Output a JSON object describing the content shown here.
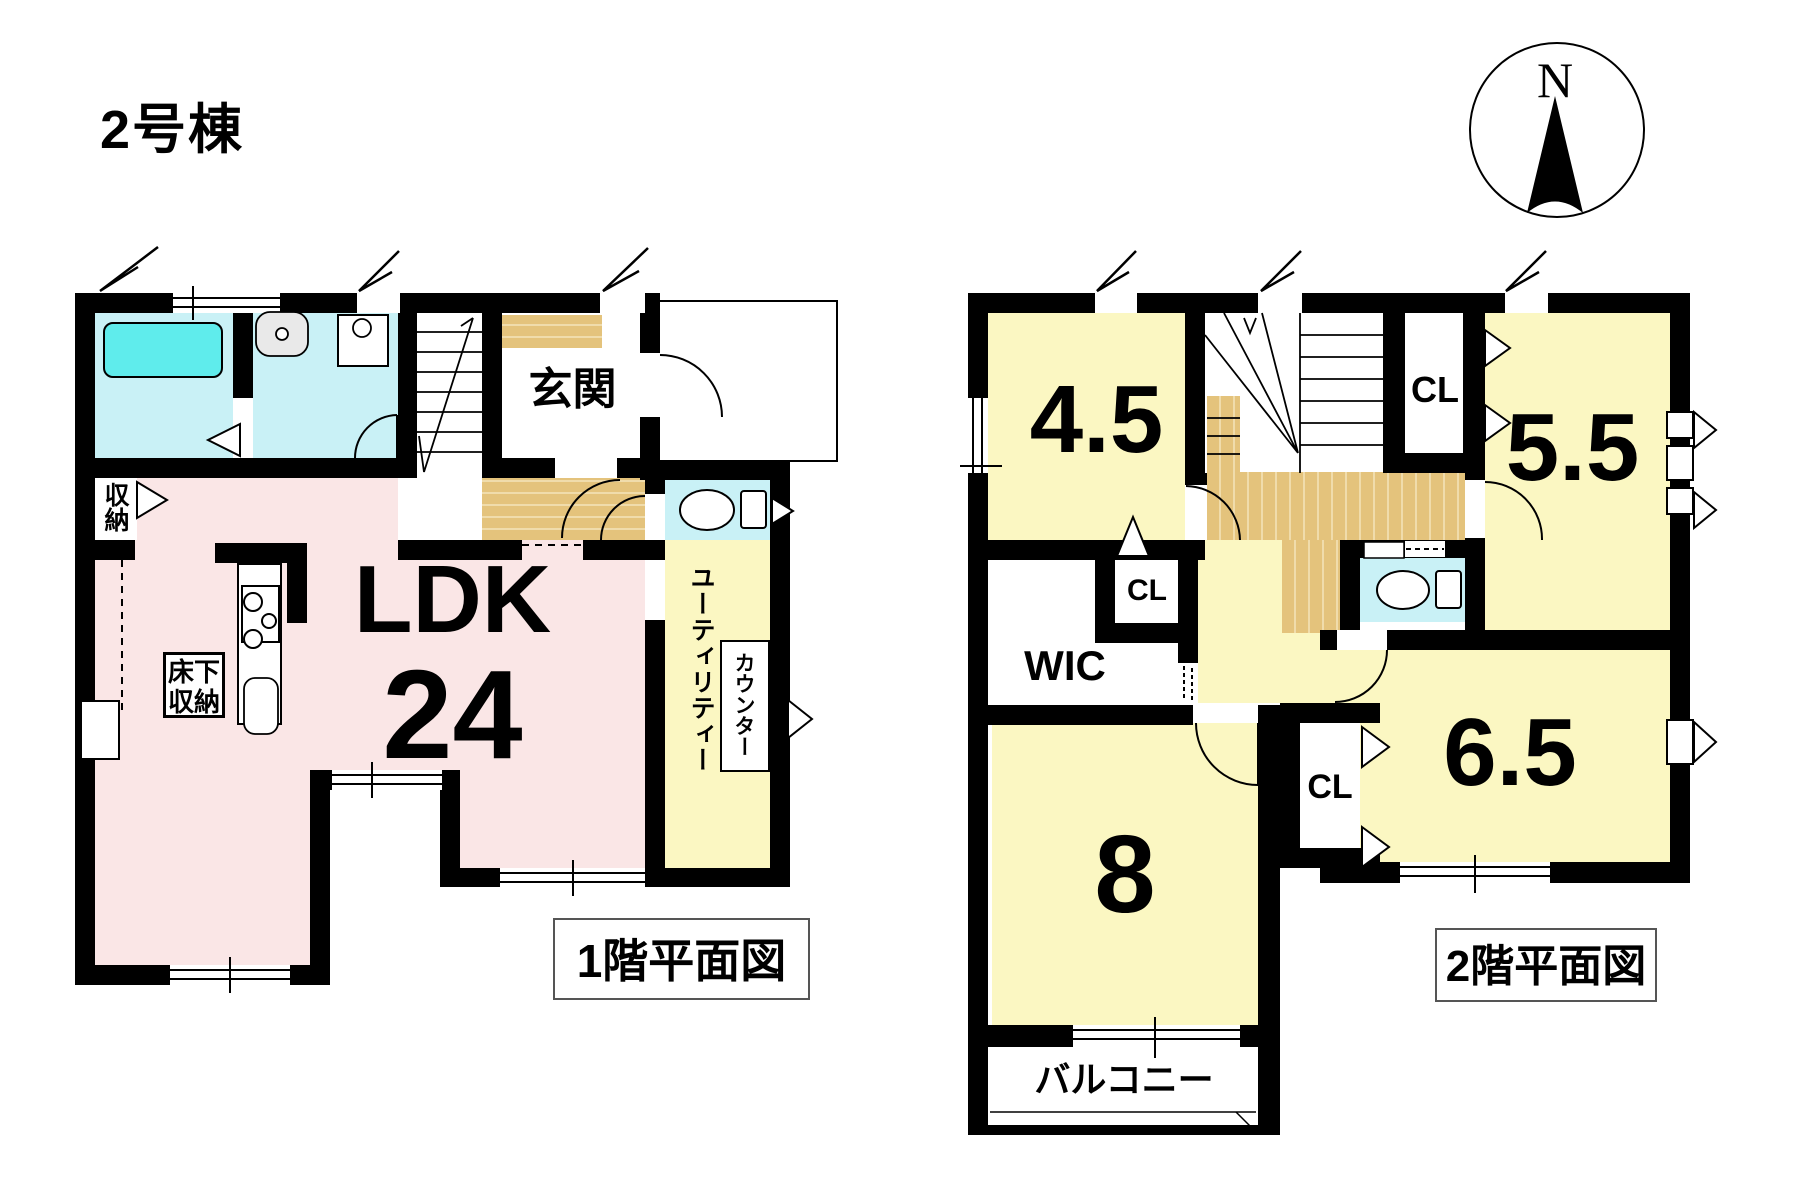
{
  "title": "2号棟",
  "compass": {
    "north_label": "N"
  },
  "colors": {
    "wall": "#000000",
    "wet_room_cyan": "#c9f1f6",
    "bathtub_cyan": "#5fecec",
    "ldk_pink": "#fae6e6",
    "room_yellow": "#fbf7c2",
    "wood_floor_tan": "#e4c37c",
    "background": "#ffffff"
  },
  "floor1": {
    "caption": "1階平面図",
    "rooms": {
      "genkan": "玄関",
      "ldk_label": "LDK",
      "ldk_size": "24",
      "closet": "収納",
      "floor_storage": "床下収納",
      "utility": "ユーティリティー",
      "counter": "カウンター"
    }
  },
  "floor2": {
    "caption": "2階平面図",
    "rooms": {
      "room_4_5": "4.5",
      "room_5_5": "5.5",
      "room_6_5": "6.5",
      "room_8": "8",
      "closet_top": "CL",
      "closet_mid": "CL",
      "closet_bottom": "CL",
      "wic": "WIC",
      "balcony": "バルコニー"
    }
  }
}
